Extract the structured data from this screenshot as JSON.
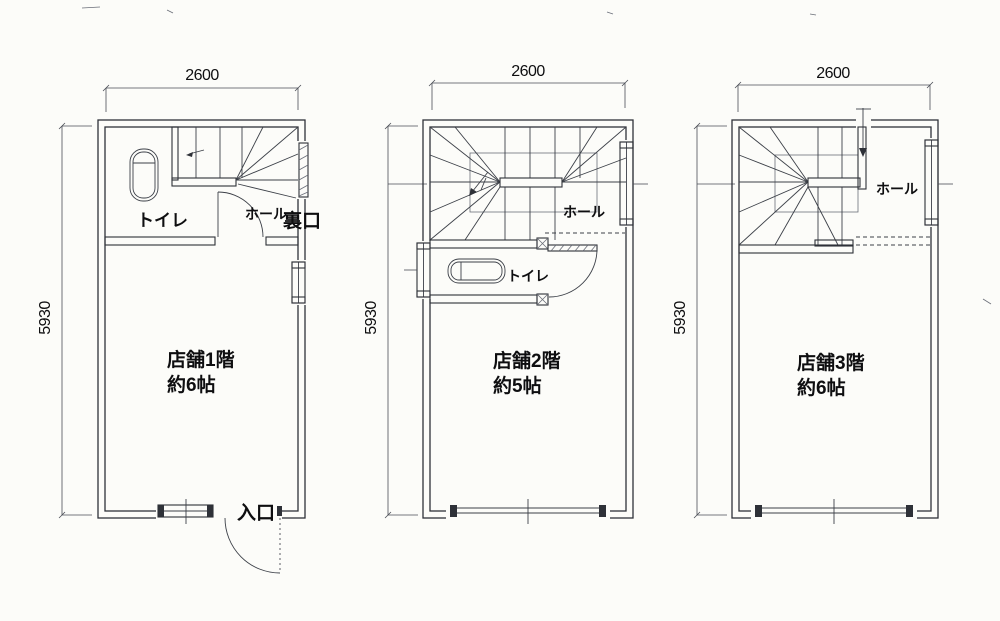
{
  "drawing": {
    "kind_note": "scanned shop floor plan, three stories",
    "colors": {
      "ink": "#2e3138",
      "text": "#0e0e10",
      "paper": "#fcfcf9"
    }
  },
  "floors": [
    {
      "top_dim": "2600",
      "side_dim": "5930",
      "room": "店舗1階",
      "size": "約6帖",
      "toilet": "トイレ",
      "hall": "ホール",
      "back_door": "裏口",
      "entrance": "入口"
    },
    {
      "top_dim": "2600",
      "side_dim": "5930",
      "room": "店舗2階",
      "size": "約5帖",
      "toilet": "トイレ",
      "hall": "ホール"
    },
    {
      "top_dim": "2600",
      "side_dim": "5930",
      "room": "店舗3階",
      "size": "約6帖",
      "hall": "ホール"
    }
  ]
}
